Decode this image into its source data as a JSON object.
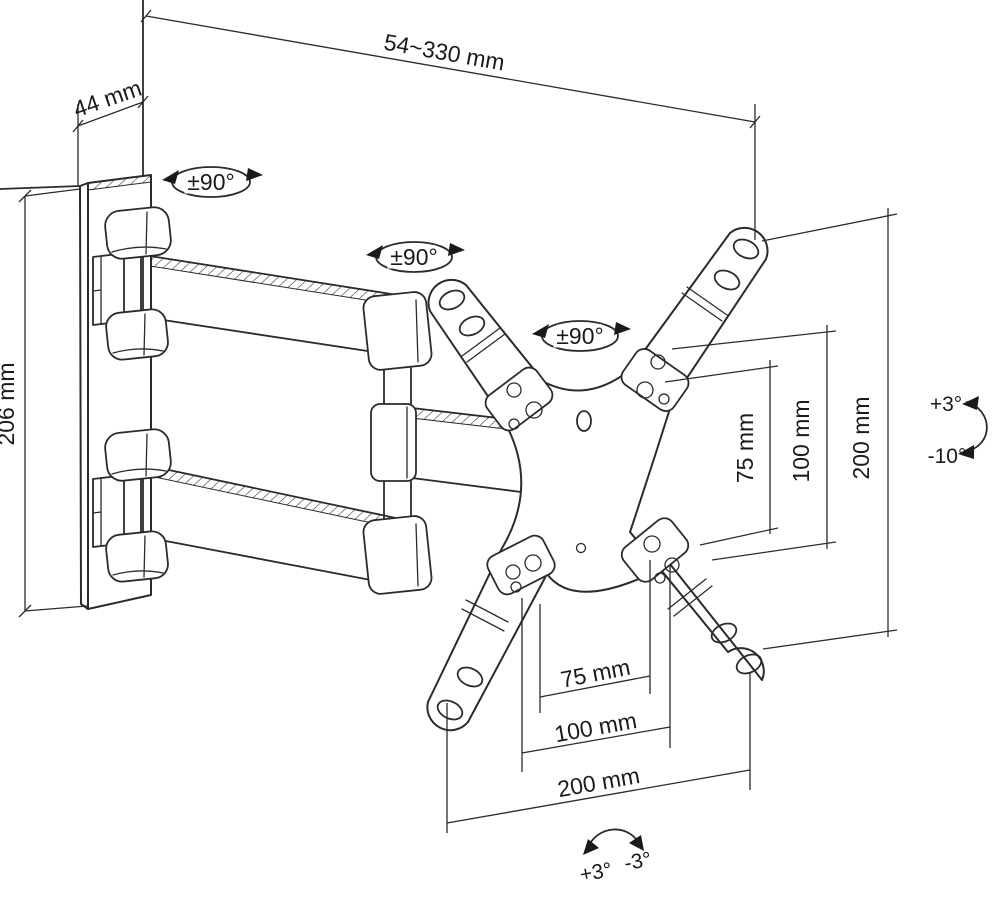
{
  "labels": {
    "extension_range": "54~330 mm",
    "wall_offset": "44 mm",
    "plate_height": "206 mm",
    "swivel_wall": "±90°",
    "swivel_mid": "±90°",
    "swivel_head": "±90°",
    "vesa_v_75": "75 mm",
    "vesa_v_100": "100 mm",
    "vesa_v_200": "200 mm",
    "tilt_up": "+3°",
    "tilt_down": "-10°",
    "vesa_h_75": "75 mm",
    "vesa_h_100": "100 mm",
    "vesa_h_200": "200 mm",
    "roll_plus": "+3°",
    "roll_minus": "-3°"
  },
  "colors": {
    "line": "#2b2b2b",
    "text": "#1a1a1a",
    "background": "#ffffff"
  }
}
